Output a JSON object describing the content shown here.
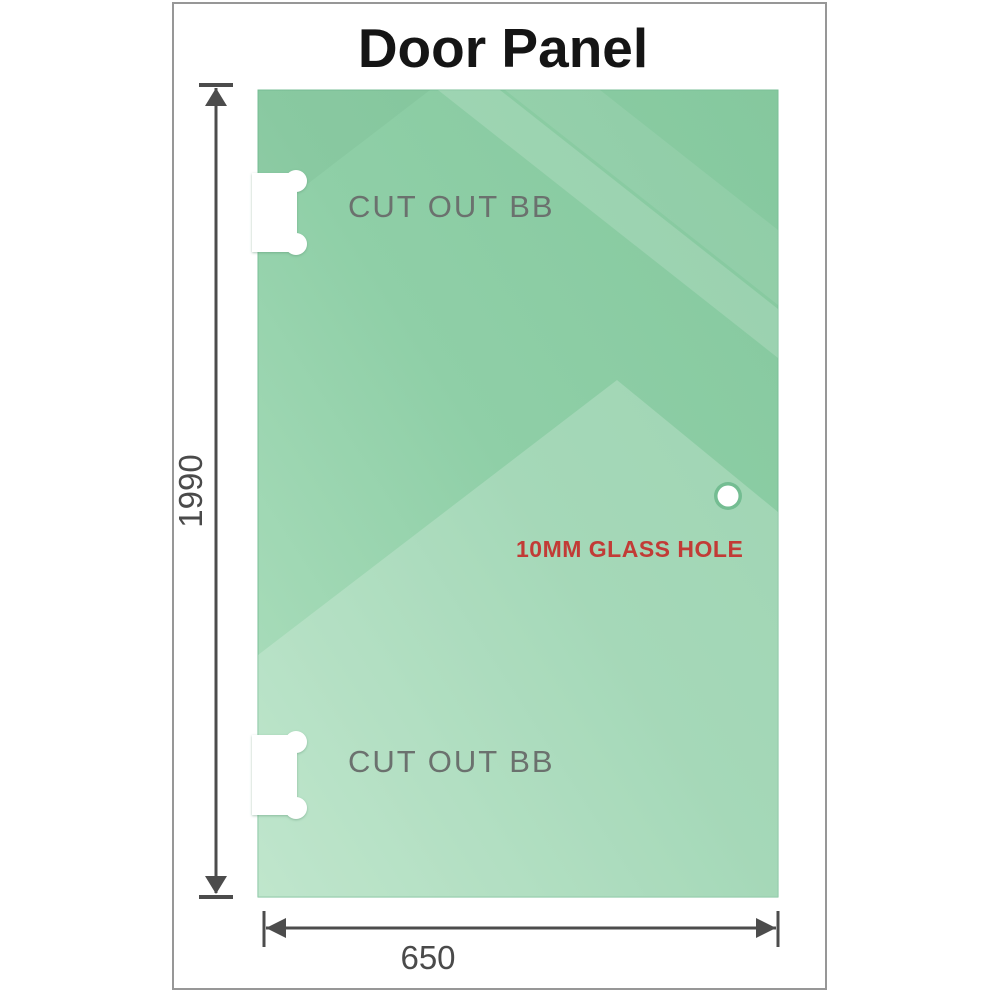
{
  "title": "Door Panel",
  "panel": {
    "cutouts": [
      {
        "label": "CUT OUT BB",
        "position": "top-left"
      },
      {
        "label": "CUT OUT BB",
        "position": "bottom-left"
      }
    ],
    "hole_label": "10MM GLASS HOLE"
  },
  "dimensions": {
    "height_mm": "1990",
    "width_mm": "650"
  },
  "colors": {
    "glass_base": "#87c99f",
    "glass_light": "#b9e4c8",
    "hole_ring": "#74bd92",
    "cutout_label_gray": "#6b716e",
    "hole_label_red": "#c23b36",
    "dimension_gray": "#4c4c4c",
    "frame_border_gray": "#979797",
    "title_black": "#151515"
  }
}
